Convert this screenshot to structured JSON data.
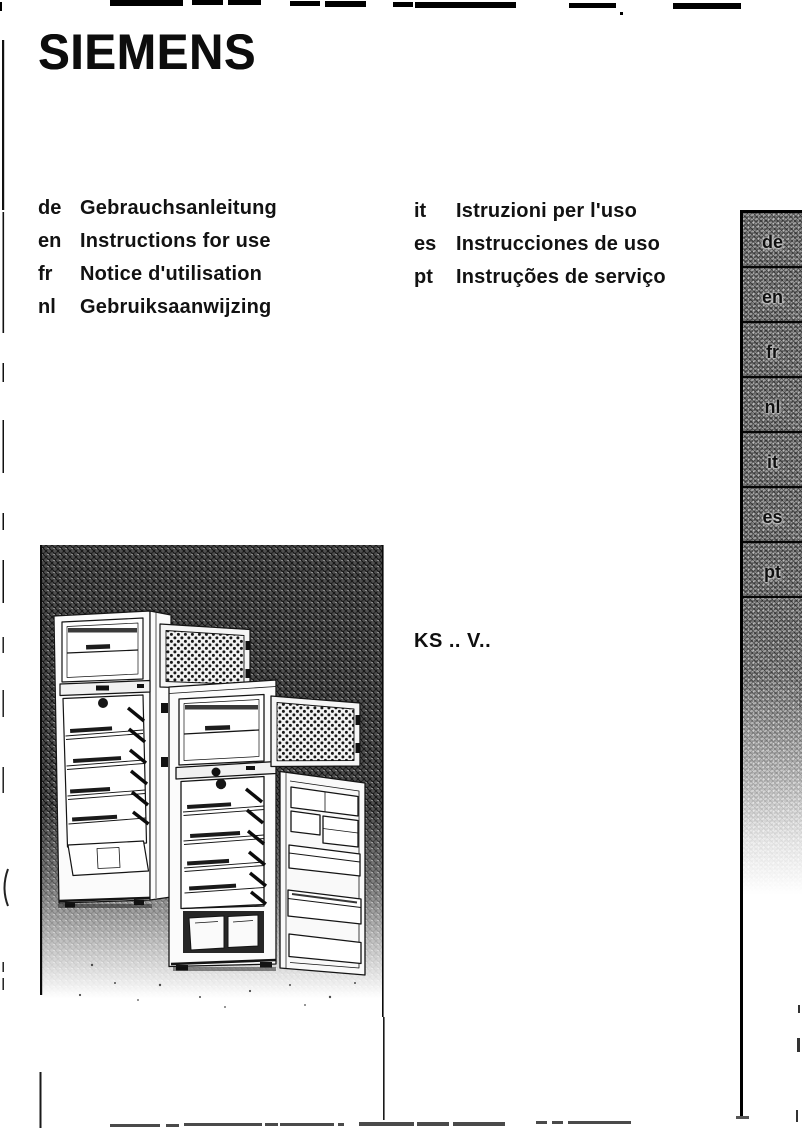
{
  "page": {
    "brand": "SIEMENS",
    "model": "KS .. V..",
    "paper_color": "#ffffff",
    "ink_color": "#141414",
    "tab_strip_gray": "#8f8f8f",
    "illustration_hatch_gray": "#4f4f4f"
  },
  "languages_left": [
    {
      "code": "de",
      "title": "Gebrauchsanleitung"
    },
    {
      "code": "en",
      "title": "Instructions for use"
    },
    {
      "code": "fr",
      "title": "Notice d'utilisation"
    },
    {
      "code": "nl",
      "title": "Gebruiksaanwijzing"
    }
  ],
  "languages_right": [
    {
      "code": "it",
      "title": "Istruzioni per l'uso"
    },
    {
      "code": "es",
      "title": "Instrucciones de uso"
    },
    {
      "code": "pt",
      "title": "Instruções de serviço"
    }
  ],
  "language_tabs": [
    "de",
    "en",
    "fr",
    "nl",
    "it",
    "es",
    "pt"
  ]
}
